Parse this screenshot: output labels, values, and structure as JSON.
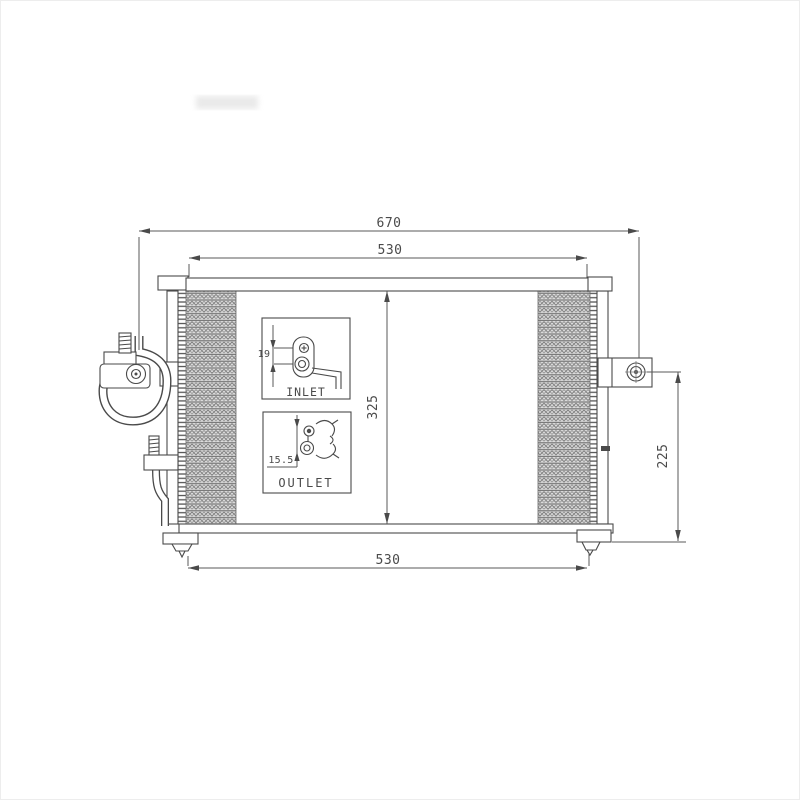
{
  "drawing": {
    "subject": "ac-condenser-technical-drawing",
    "view": "front",
    "dims": {
      "overall_width": "670",
      "top_width": "530",
      "core_height": "325",
      "bracket_height": "225",
      "bottom_width": "530"
    },
    "inlet_inset": {
      "label": "INLET",
      "pipe_dim": "19"
    },
    "outlet_inset": {
      "label": "OUTLET",
      "pipe_dim": "15.5"
    },
    "colors": {
      "background": "#ffffff",
      "line": "#4a4a4a",
      "dim_line": "#5a5a5a",
      "fin_fill": "#dcdcdc",
      "fin_hatch": "#6f6f6f"
    }
  }
}
